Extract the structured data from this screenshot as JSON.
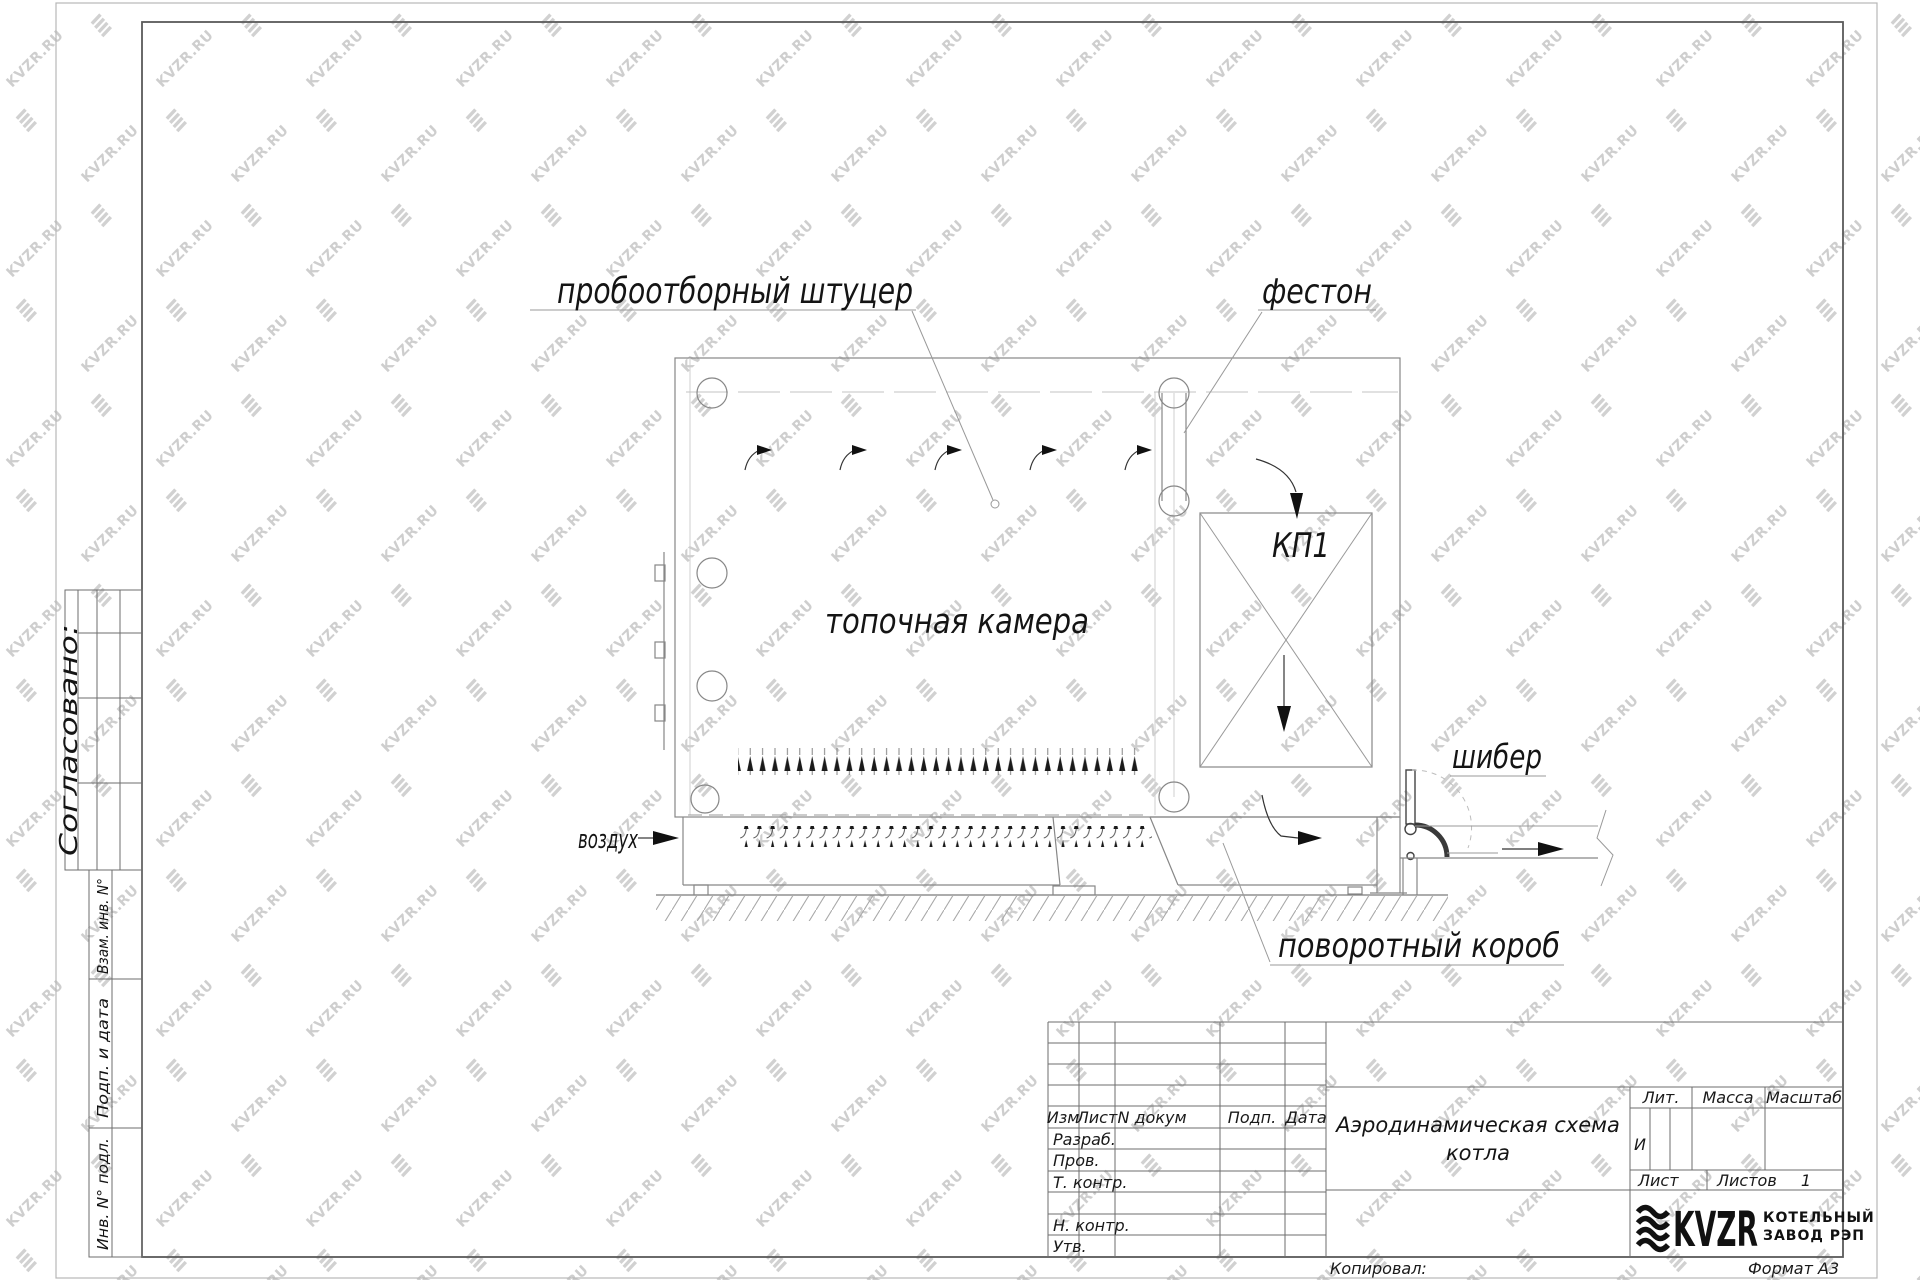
{
  "watermark": {
    "text": "KVZR.RU",
    "color": "#c6c6c6"
  },
  "drawing": {
    "labels": {
      "sampling_fitting": "пробоотборный штуцер",
      "festoon": "фестон",
      "kp1": "КП1",
      "furnace_chamber": "топочная камера",
      "damper": "шибер",
      "air": "воздух",
      "turning_duct": "поворотный короб"
    }
  },
  "title_block": {
    "title_line1": "Аэродинамическая схема",
    "title_line2": "котла",
    "headers": {
      "izm": "Изм",
      "list": "Лист",
      "n_dokum": "N докум",
      "podp": "Подп.",
      "data": "Дата"
    },
    "rows": {
      "razrab": "Разраб.",
      "prov": "Пров.",
      "t_kontr": "Т. контр.",
      "n_kontr": "Н. контр.",
      "utv": "Утв."
    },
    "lit_label": "Лит.",
    "massa_label": "Масса",
    "masshtab_label": "Масштаб",
    "lit_value": "И",
    "list_label": "Лист",
    "listov_label": "Листов",
    "listov_value": "1",
    "logo_text": "KVZR",
    "logo_sub1": "КОТЕЛЬНЫЙ",
    "logo_sub2": "ЗАВОД РЭП",
    "kopiroval": "Копировал:",
    "format": "Формат А3"
  },
  "side_panel": {
    "soglasovano": "Согласовано:",
    "vzam": "Взам. инв. N°",
    "podp_data": "Подп. и дата",
    "inv_podl": "Инв. N° подл."
  }
}
